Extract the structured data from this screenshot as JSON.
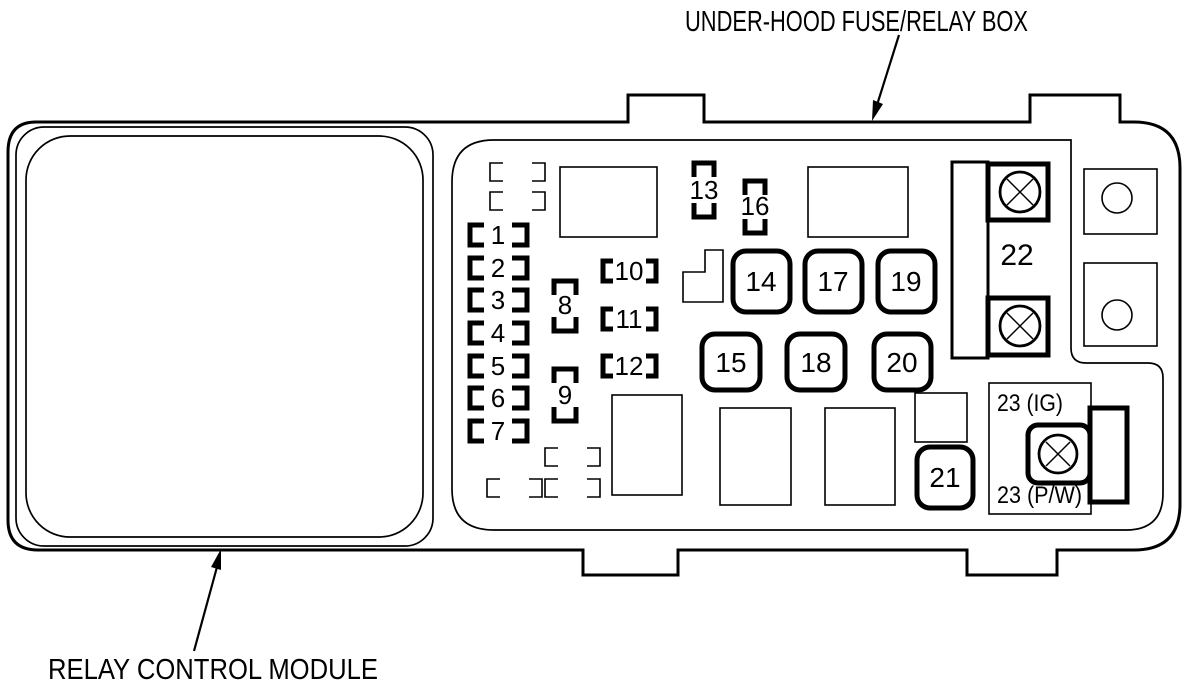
{
  "labels": {
    "title": "UNDER-HOOD FUSE/RELAY BOX",
    "module": "RELAY CONTROL MODULE"
  },
  "fuses": {
    "f1": "1",
    "f2": "2",
    "f3": "3",
    "f4": "4",
    "f5": "5",
    "f6": "6",
    "f7": "7",
    "f8": "8",
    "f9": "9",
    "f10": "10",
    "f11": "11",
    "f12": "12",
    "f13": "13",
    "f16": "16",
    "f14": "14",
    "f17": "17",
    "f19": "19",
    "f15": "15",
    "f18": "18",
    "f20": "20",
    "f21": "21",
    "f22": "22",
    "f23_ig": "23 (IG)",
    "f23_pw": "23 (P/W)"
  }
}
